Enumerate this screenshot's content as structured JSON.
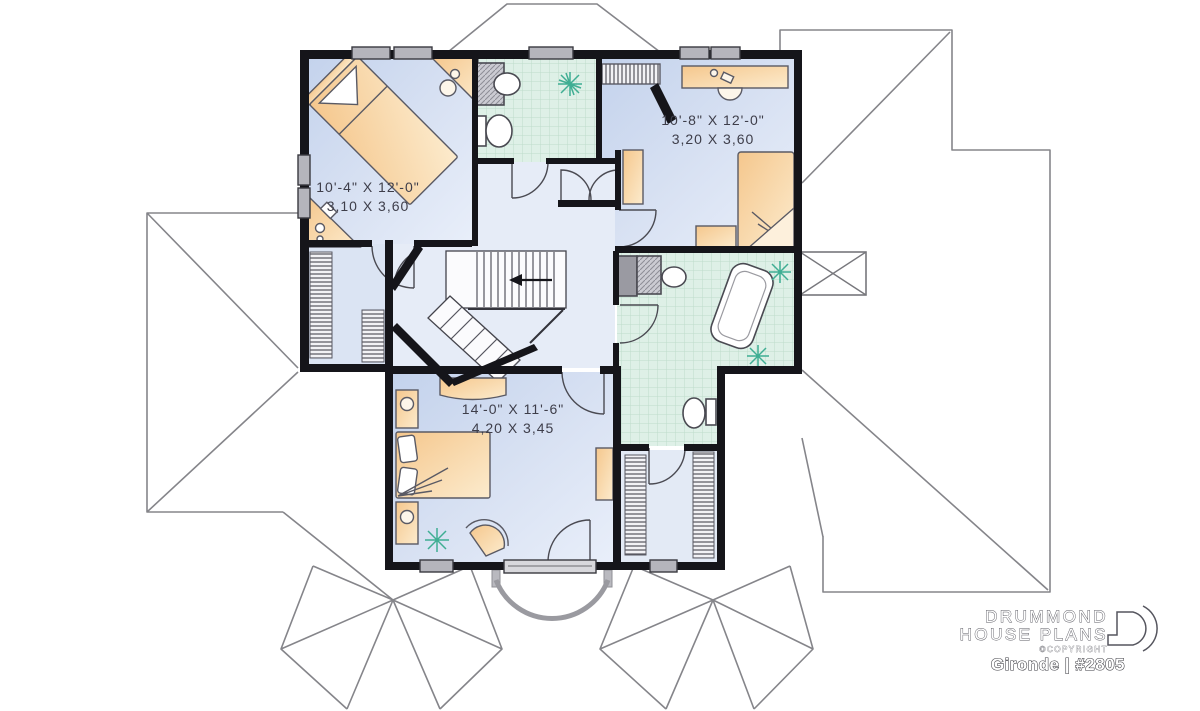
{
  "document": {
    "type": "floor-plan",
    "view": "second-floor"
  },
  "rooms": [
    {
      "name": "bedroom-1",
      "dim_imperial": "10'-4\" X 12'-0\"",
      "dim_metric": "3,10 X 3,60"
    },
    {
      "name": "bedroom-2",
      "dim_imperial": "10'-8\" X 12'-0\"",
      "dim_metric": "3,20 X 3,60"
    },
    {
      "name": "master-bedroom",
      "dim_imperial": "14'-0\" X 11'-6\"",
      "dim_metric": "4,20 X 3,45"
    }
  ],
  "branding": {
    "company_line1": "DRUMMOND",
    "company_line2": "HOUSE PLANS",
    "copyright_note": "©COPYRIGHT",
    "plan_label": "Gironde | #2805"
  },
  "colors": {
    "wall": "#15151a",
    "floor_blue": "#ccd9ee",
    "floor_hall": "#e6ecf7",
    "tile_green": "#ddefe6",
    "furniture": "#f6cf9a",
    "roof_line": "#85858a",
    "plant": "#3fae93",
    "window_gray": "#b5b5bc"
  }
}
